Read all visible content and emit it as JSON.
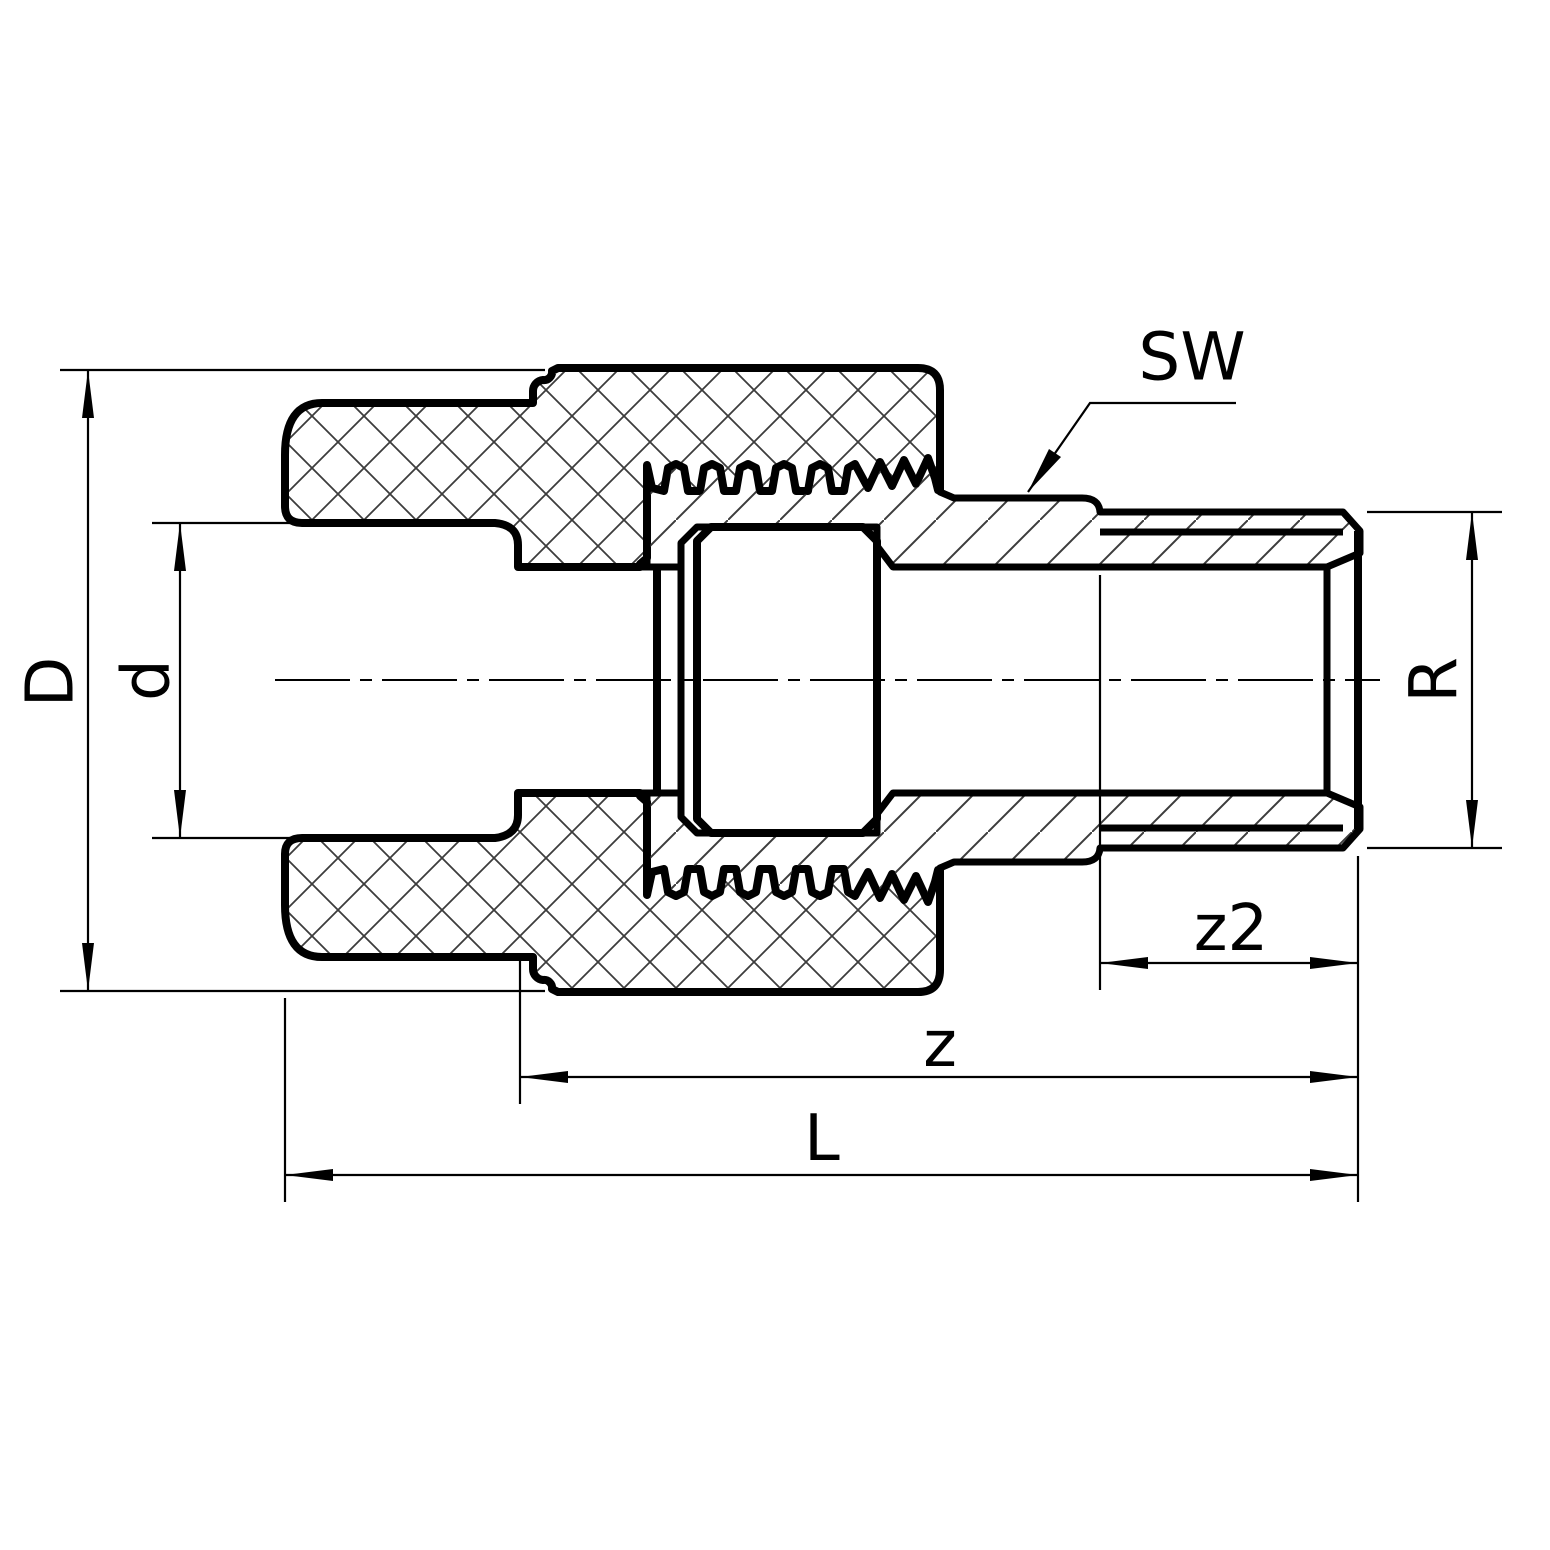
{
  "title": "Technical section drawing of a PPR union adapter with male metal thread insert",
  "drawing": {
    "background_color": "#ffffff",
    "outline_color": "#000000",
    "hatch_color": "#3c3c3c",
    "labels": {
      "outer_diameter": "D",
      "socket_inner_diameter": "d",
      "wrench_size": "SW",
      "thread_size": "R",
      "thread_engagement": "z2",
      "insertion_offset": "z",
      "overall_length": "L"
    }
  }
}
